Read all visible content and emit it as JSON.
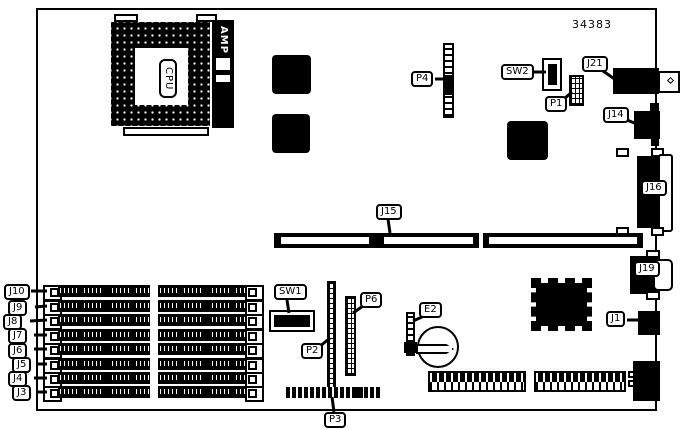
{
  "figure_number": "34383",
  "cpu": {
    "label": "CPU",
    "socket_brand": "AMP"
  },
  "callouts": {
    "p4": "P4",
    "sw2": "SW2",
    "p1": "P1",
    "j21": "J21",
    "j14": "J14",
    "j16": "J16",
    "j19": "J19",
    "j1": "J1",
    "j15": "J15",
    "sw1": "SW1",
    "p2": "P2",
    "p6": "P6",
    "p3": "P3",
    "e2": "E2"
  },
  "memory_slots": [
    {
      "label": "J10"
    },
    {
      "label": "J9"
    },
    {
      "label": "J8"
    },
    {
      "label": "J7"
    },
    {
      "label": "J6"
    },
    {
      "label": "J5"
    },
    {
      "label": "J4"
    },
    {
      "label": "J3"
    }
  ],
  "colors": {
    "line": "#000000",
    "background": "#ffffff"
  }
}
